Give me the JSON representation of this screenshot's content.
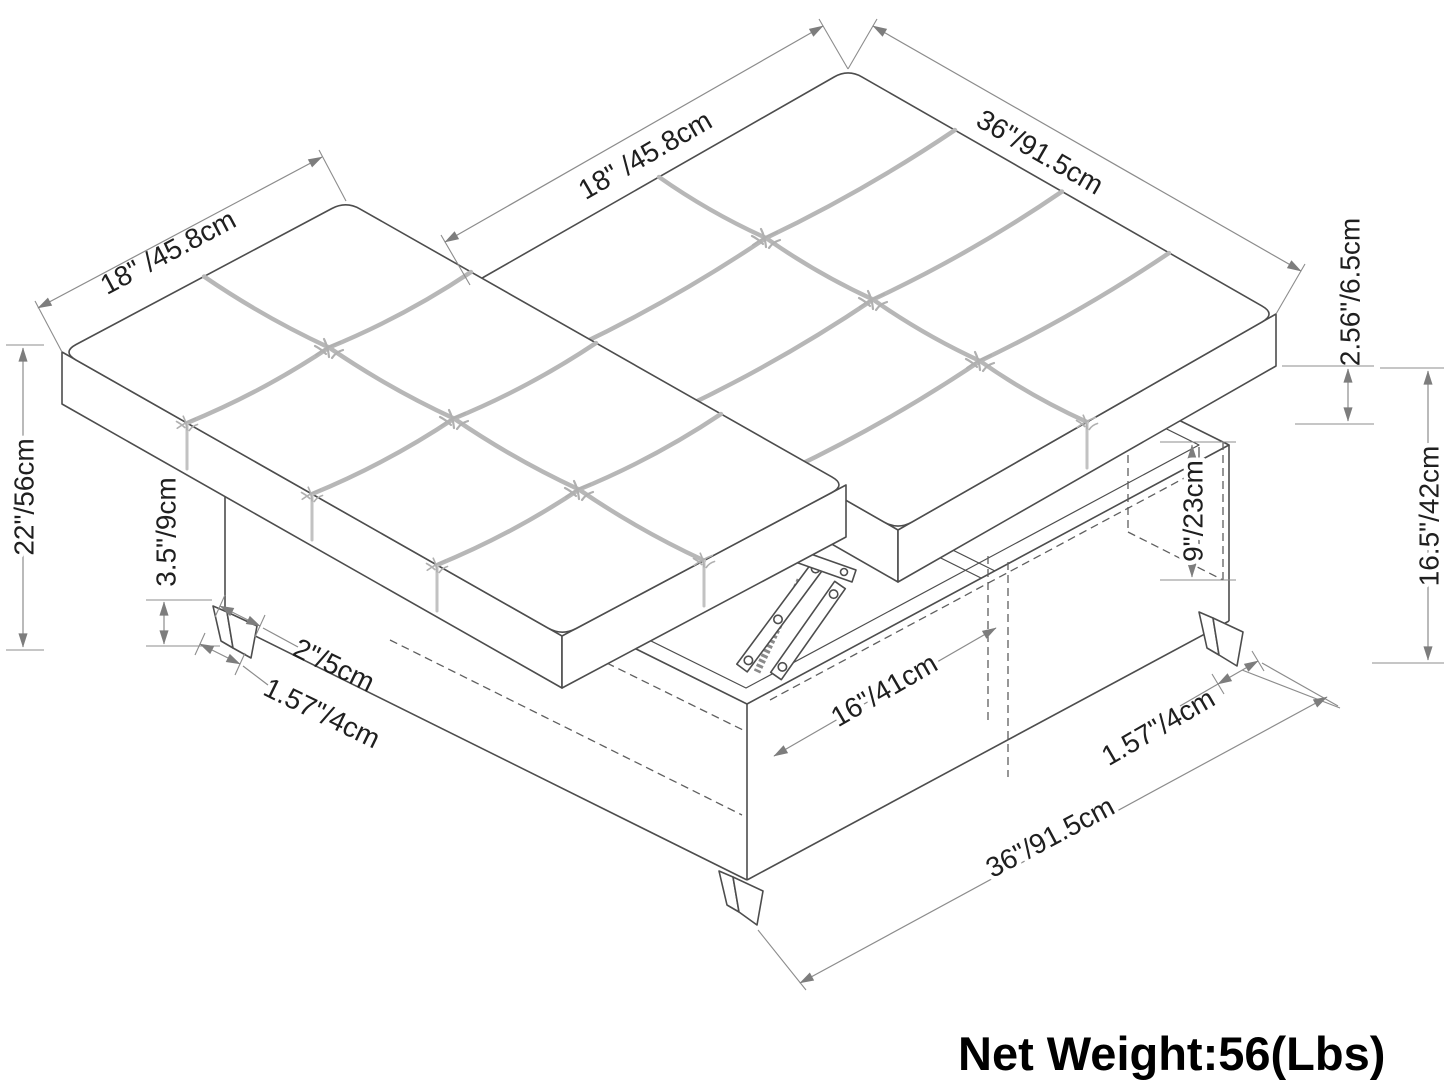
{
  "diagram": {
    "type": "furniture-dimension-drawing",
    "product": "tufted storage ottoman with split lift-top cushions",
    "labels": {
      "dim_18_left": "18\" /45.8cm",
      "dim_18_mid": "18\" /45.8cm",
      "dim_36_top": "36\"/91.5cm",
      "dim_cushion_thickness": "2.56\"/6.5cm",
      "dim_storage_depth": "9\"/23cm",
      "dim_height_right": "16.5\"/42cm",
      "dim_height_left": "22\"/56cm",
      "dim_leg_height": "3.5\"/9cm",
      "dim_leg_width": "2\"/5cm",
      "dim_leg_inset_left": "1.57\"/4cm",
      "dim_opening": "16\"/41cm",
      "dim_leg_inset_right": "1.57\"/4cm",
      "dim_36_bottom": "36\"/91.5cm"
    },
    "footer": {
      "net_weight": "Net Weight:56(Lbs)"
    },
    "colors": {
      "outline": "#4d4d4d",
      "seam": "#b7b7b7",
      "dimension_line": "#8c8c8c",
      "label_text": "#1f1f1f",
      "background": "#ffffff"
    }
  }
}
